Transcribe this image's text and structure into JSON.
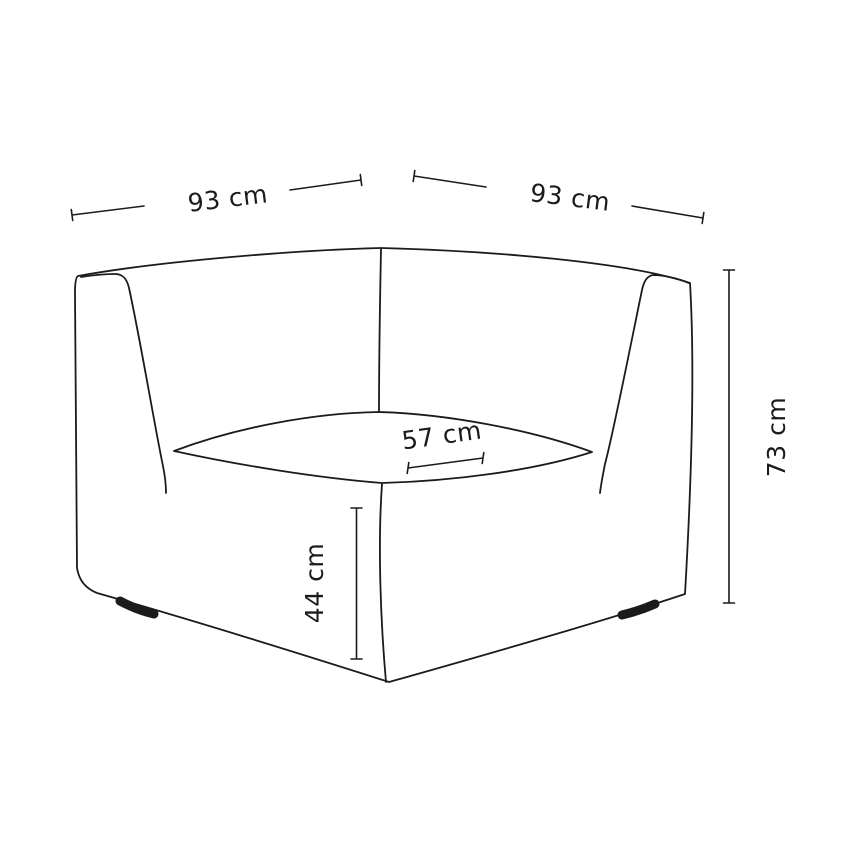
{
  "page": {
    "background": "#ffffff",
    "line_color": "#1b1b1b"
  },
  "drawing": {
    "subject": "corner-sofa-module-dimension-diagram"
  },
  "dimensions": {
    "back_width_left": {
      "label": "93 cm"
    },
    "back_width_right": {
      "label": "93 cm"
    },
    "overall_height": {
      "label": "73 cm"
    },
    "seat_depth": {
      "label": "57 cm"
    },
    "seat_height": {
      "label": "44 cm"
    }
  }
}
